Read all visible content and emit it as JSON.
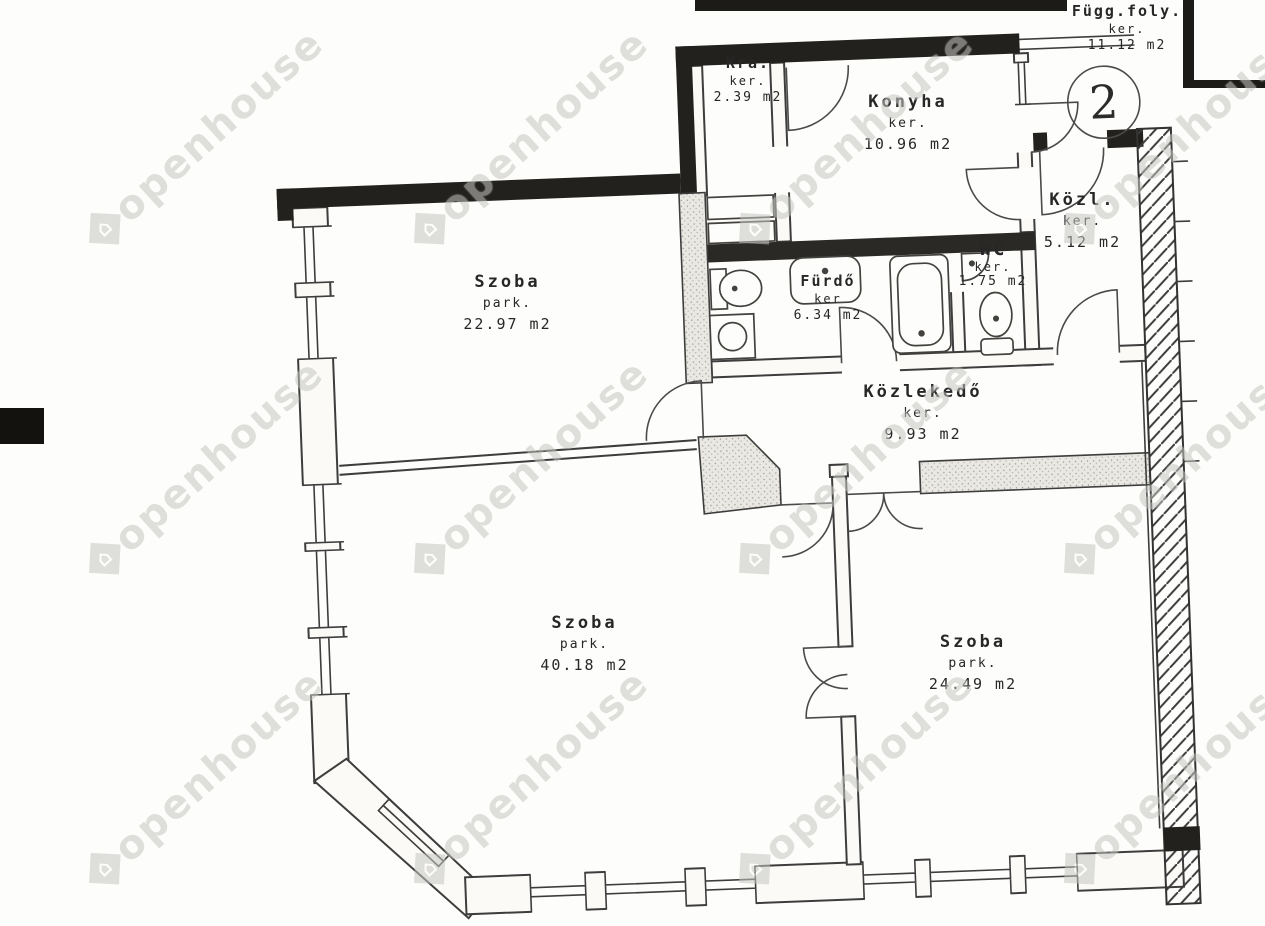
{
  "plan": {
    "apartment_number": "2",
    "rooms": {
      "fugg_foly": {
        "name": "Függ.foly.",
        "finish": "ker.",
        "area": "11.12 m2"
      },
      "kra": {
        "name": "Kra.",
        "finish": "ker.",
        "area": "2.39 m2"
      },
      "konyha": {
        "name": "Konyha",
        "finish": "ker.",
        "area": "10.96 m2"
      },
      "kozl": {
        "name": "Közl.",
        "finish": "ker.",
        "area": "5.12 m2"
      },
      "wc": {
        "name": "WC",
        "finish": "ker.",
        "area": "1.75 m2"
      },
      "furdo": {
        "name": "Fürdő",
        "finish": "ker",
        "area": "6.34 m2"
      },
      "kozlekedo": {
        "name": "Közlekedő",
        "finish": "ker.",
        "area": "9.93 m2"
      },
      "szoba_1": {
        "name": "Szoba",
        "finish": "park.",
        "area": "22.97 m2"
      },
      "szoba_2": {
        "name": "Szoba",
        "finish": "park.",
        "area": "40.18 m2"
      },
      "szoba_3": {
        "name": "Szoba",
        "finish": "park.",
        "area": "24.49 m2"
      }
    },
    "watermark": {
      "text": "openhouse",
      "icon_glyph": "⌂"
    },
    "colors": {
      "wall_dark": "#23211d",
      "wall_fill": "#e7e5df",
      "line": "#3d3d3d"
    }
  }
}
